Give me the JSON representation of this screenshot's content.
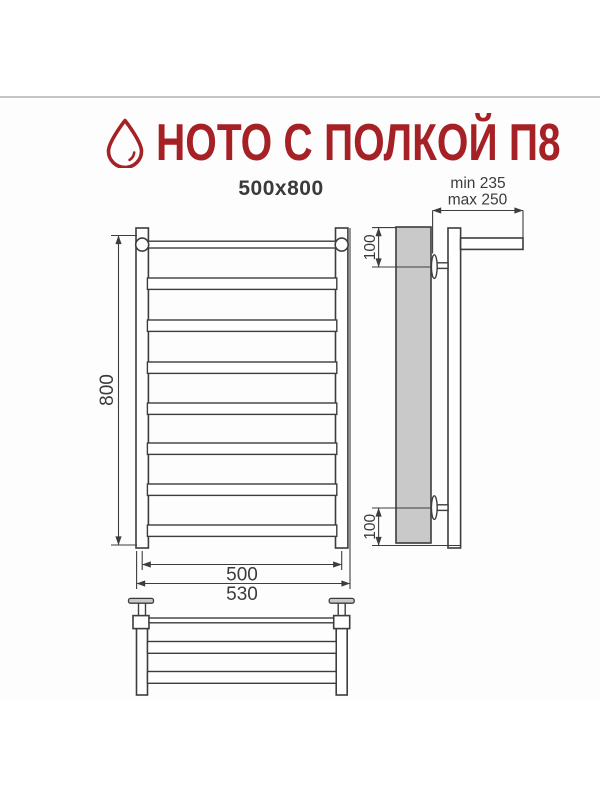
{
  "page": {
    "title": "НОТО С ПОЛКОЙ П8",
    "size_label": "500x800"
  },
  "logo": {
    "icon": "water-drop",
    "color": "#a62125"
  },
  "dimensions": {
    "height": "800",
    "rail_width": "500",
    "overall_width": "530",
    "wall_offset_top": "100",
    "wall_offset_bottom": "100",
    "shelf_depth_min": "min 235",
    "shelf_depth_max": "max 250"
  },
  "drawing": {
    "front_view_bars": 8,
    "shelf_bars": 2,
    "line_color": "#3d3d3d",
    "wall_fill": "#c9c9c9",
    "divider_color": "#c6c6c6"
  }
}
